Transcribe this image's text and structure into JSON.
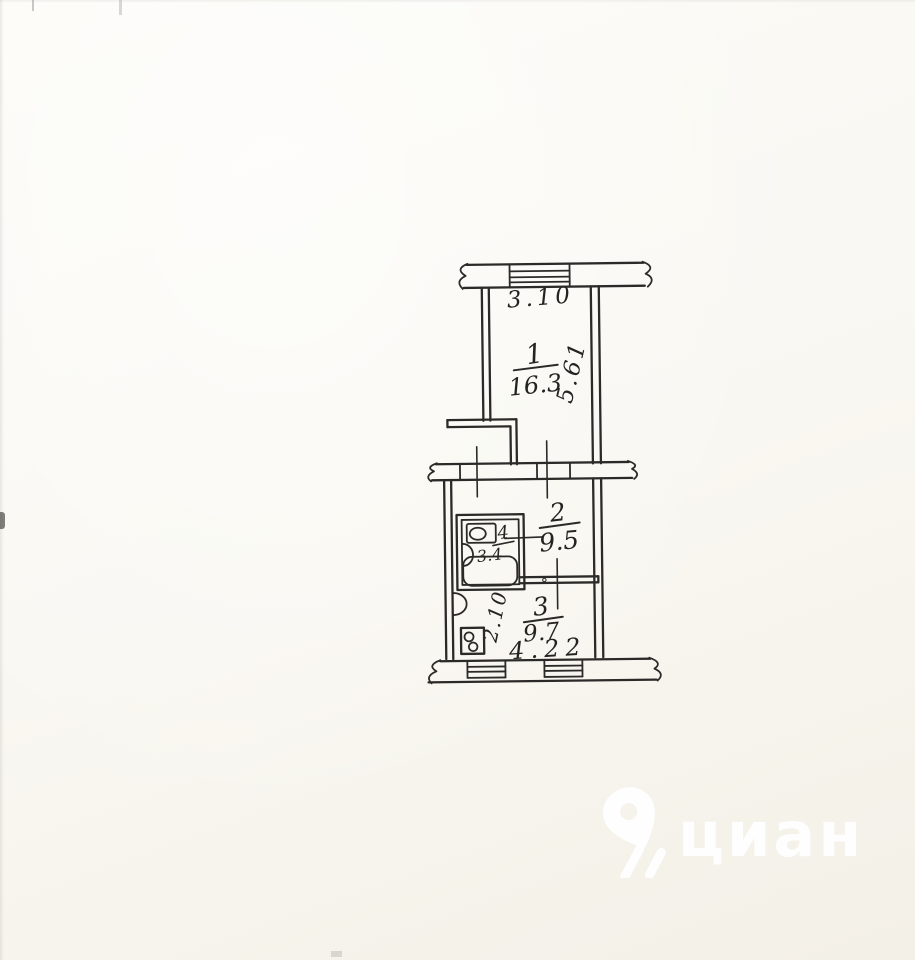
{
  "plan": {
    "rooms": [
      {
        "id": "room-1",
        "number": "1",
        "area": "16.3"
      },
      {
        "id": "room-2",
        "number": "2",
        "area": "9.5"
      },
      {
        "id": "room-3",
        "number": "3",
        "area": "9.7"
      },
      {
        "id": "bathroom",
        "number": "4",
        "area": "3.4"
      }
    ],
    "dimensions": {
      "top_width": "3.10",
      "right_height": "5.61",
      "hall_height": "2.10",
      "bottom_width": "4.22"
    },
    "icons": {
      "toilet": "toilet-icon",
      "sink": "sink-icon",
      "bathtub": "bathtub-icon",
      "stove": "stove-icon"
    }
  },
  "watermark": {
    "text": "циан",
    "icon": "cian-pin-icon"
  },
  "colors": {
    "ink": "#2b2a28",
    "paper": "#f9f7f1",
    "watermark": "#ffffff"
  }
}
